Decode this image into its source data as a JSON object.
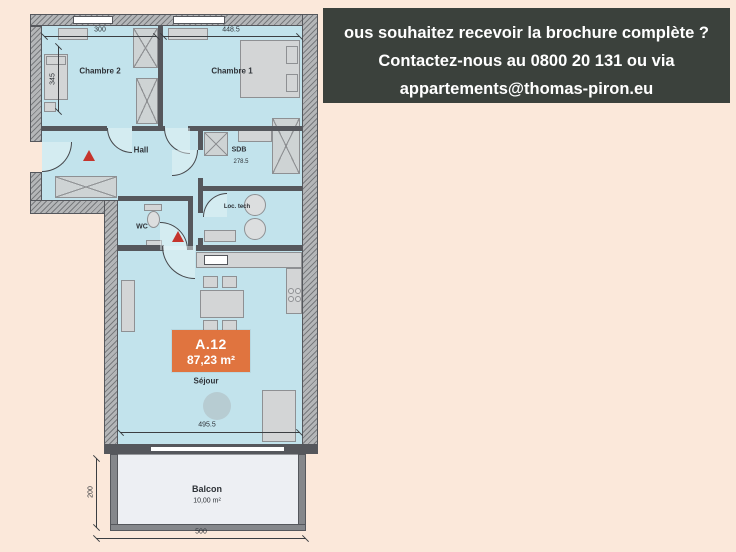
{
  "banner": {
    "line1": "ous souhaitez recevoir la brochure complète ?",
    "line2": "Contactez-nous au 0800 20 131 ou via",
    "line3": "appartements@thomas-piron.eu"
  },
  "unit": {
    "code": "A.12",
    "area": "87,23 m²"
  },
  "rooms": {
    "chambre2": "Chambre 2",
    "chambre1": "Chambre 1",
    "hall": "Hall",
    "sdb": "SDB",
    "wc": "WC",
    "loctech": "Loc. tech",
    "sejour": "Séjour",
    "balcon": "Balcon",
    "balcon_area": "10,00 m²"
  },
  "dimensions": {
    "chambre2_width": "300",
    "chambre1_width": "448.5",
    "chambre2_depth": "345",
    "sdb_width": "278.5",
    "sejour_width": "495.5",
    "balcon_depth": "200",
    "balcon_width": "500"
  },
  "colors": {
    "background": "#fbe8da",
    "banner_bg": "#3b413c",
    "banner_text": "#ffffff",
    "room_fill": "#c2e3ec",
    "wall": "#55575c",
    "exterior_wall": "#b4b6b8",
    "badge_bg": "#e0743f",
    "marker_red": "#c5342c",
    "balcony_fill": "#edeff3"
  }
}
